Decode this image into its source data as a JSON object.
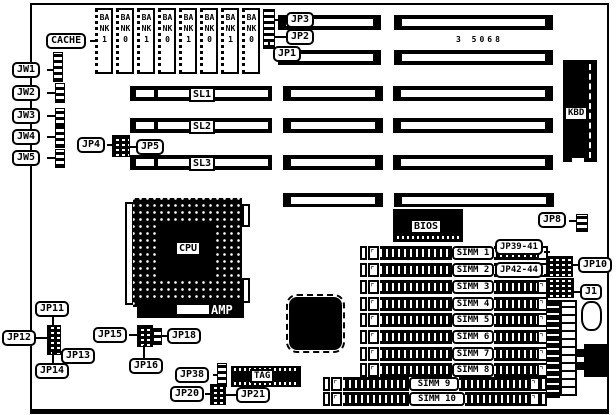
{
  "board": {
    "part_number": "3 5068"
  },
  "callouts": {
    "cache": "CACHE",
    "jw1": "JW1",
    "jw2": "JW2",
    "jw3": "JW3",
    "jw4": "JW4",
    "jw5": "JW5",
    "jp1": "JP1",
    "jp2": "JP2",
    "jp3": "JP3",
    "jp4": "JP4",
    "jp5": "JP5",
    "jp8": "JP8",
    "jp10": "JP10",
    "jp11": "JP11",
    "jp12": "JP12",
    "jp13": "JP13",
    "jp14": "JP14",
    "jp15": "JP15",
    "jp16": "JP16",
    "jp18": "JP18",
    "jp20": "JP20",
    "jp21": "JP21",
    "jp38": "JP38",
    "jp39_41": "JP39-41",
    "jp42_44": "JP42-44",
    "j1": "J1"
  },
  "chips": {
    "cpu": "CPU",
    "bios": "BIOS",
    "kbd": "KBD",
    "tag": "TAG",
    "amp": "AMP",
    "banks": [
      "BANK1",
      "BANK0",
      "BANK1",
      "BANK0",
      "BANK1",
      "BANK0",
      "BANK1",
      "BANK0"
    ]
  },
  "slots": {
    "sl1": "SL1",
    "sl2": "SL2",
    "sl3": "SL3"
  },
  "simms": [
    "SIMM 1",
    "SIMM 2",
    "SIMM 3",
    "SIMM 4",
    "SIMM 5",
    "SIMM 6",
    "SIMM 7",
    "SIMM 8",
    "SIMM 9",
    "SIMM 10"
  ]
}
